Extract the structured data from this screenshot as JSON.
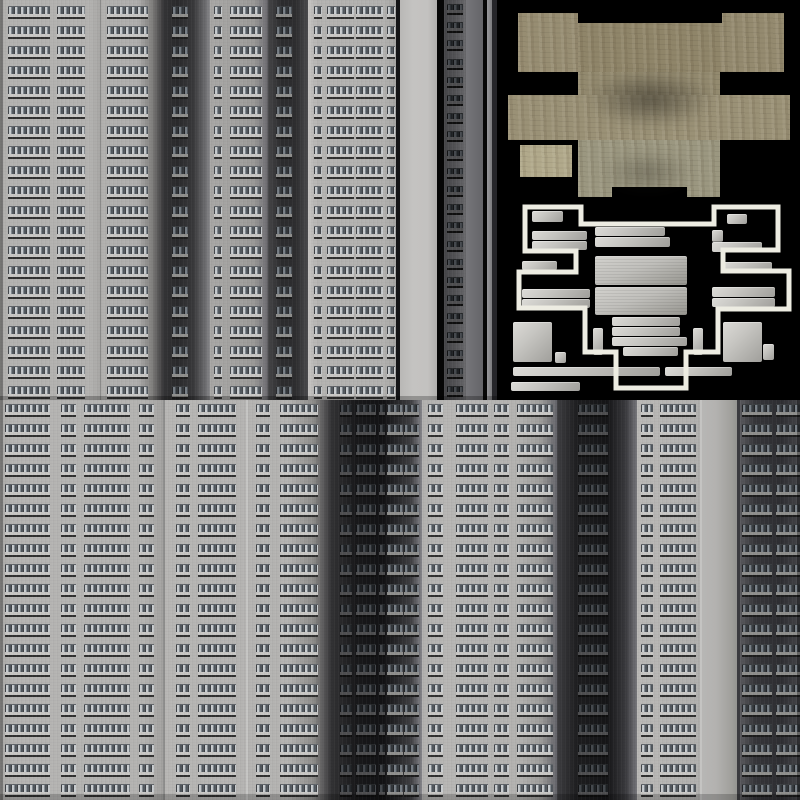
{
  "meta": {
    "description": "building facade texture atlas with rooftop diffuse map",
    "canvas": {
      "w": 800,
      "h": 800
    },
    "background_color": "#0a0a0a"
  },
  "palette": {
    "black": "#060606",
    "light_wall": "#b3b2b0",
    "roof_tan": "#978d72",
    "outline_white": "#edece2",
    "window_tones": {
      "light": {
        "top": "#61656a",
        "frame": "#3f4246",
        "pane1": "#c9cdd0",
        "pane2": "#82898f",
        "frame2": "#51575d",
        "ledge": "#c8c7c5",
        "shadow": "#303030"
      },
      "dim": {
        "top": "#3c3f42",
        "frame": "#232528",
        "pane1": "#787f86",
        "pane2": "#4b5157",
        "frame2": "#33373b",
        "ledge": "#8f8f8d",
        "shadow": "#1c1c1c"
      },
      "dark": {
        "top": "#26282a",
        "frame": "#131416",
        "pane1": "#45494e",
        "pane2": "#2b2f33",
        "frame2": "#1e2124",
        "ledge": "#4e4e50",
        "shadow": "#0e0e0e"
      }
    }
  },
  "top_section": {
    "y": 0,
    "h": 400,
    "rows": {
      "start": 6,
      "pitch": 20,
      "count": 20,
      "cell": 13
    },
    "strips": [
      {
        "name": "facade-t1",
        "x": 0,
        "w": 100,
        "wall": "linear-gradient(90deg,#a6a5a3 0%,#b3b2b0 6%,#b3b2b0 90%,#a8a7a5 100%)",
        "windows": [
          {
            "x": 8,
            "w": 42,
            "tone": "light"
          },
          {
            "x": 57,
            "w": 28,
            "tone": "light"
          }
        ]
      },
      {
        "name": "facade-t2",
        "x": 100,
        "w": 63,
        "wall": "linear-gradient(90deg,#b1b0ae 0%,#afaead 60%,#82817f 82%,#3a393b 100%)",
        "windows": [
          {
            "x": 7,
            "w": 41,
            "tone": "light"
          }
        ]
      },
      {
        "name": "facade-t3",
        "x": 163,
        "w": 47,
        "wall": "linear-gradient(90deg,#353537 0%,#2a2a2c 30%,#39393b 65%,#707073 92%,#8b8b8e 100%)",
        "windows": [
          {
            "x": 9,
            "w": 16,
            "tone": "dim"
          }
        ]
      },
      {
        "name": "facade-t4",
        "x": 210,
        "w": 58,
        "wall": "linear-gradient(90deg,#a8a7a5 0%,#a2a19f 45%,#9b9a98 75%,#77767a 95%,#5f5e62 100%)",
        "windows": [
          {
            "x": 4,
            "w": 8,
            "tone": "light"
          },
          {
            "x": 20,
            "w": 32,
            "tone": "light"
          }
        ]
      },
      {
        "name": "facade-t5",
        "x": 268,
        "w": 40,
        "wall": "linear-gradient(90deg,#454547 0%,#2c2c2e 35%,#2e2e30 70%,#4a4a4d 100%)",
        "windows": [
          {
            "x": 8,
            "w": 16,
            "tone": "dim"
          }
        ]
      },
      {
        "name": "facade-t6",
        "x": 308,
        "w": 88,
        "wall": "linear-gradient(90deg,#c2c1bf 0%,#b4b3b1 12%,#b2b1af 86%,#a6a5a3 100%)",
        "windows": [
          {
            "x": 6,
            "w": 8,
            "tone": "light"
          },
          {
            "x": 19,
            "w": 27,
            "tone": "light"
          },
          {
            "x": 48,
            "w": 27,
            "tone": "light"
          },
          {
            "x": 79,
            "w": 8,
            "tone": "light"
          }
        ]
      },
      {
        "name": "facade-t8-narrow",
        "x": 444,
        "w": 22,
        "wall": "linear-gradient(90deg,#454548 0%,#525255 50%,#68686b 100%)",
        "rows": {
          "start": 4,
          "pitch": 18.2,
          "count": 22,
          "cell": 11
        },
        "windows": [
          {
            "x": 3,
            "w": 16,
            "tone": "dark"
          }
        ]
      }
    ]
  },
  "bottom_section": {
    "y": 400,
    "h": 400,
    "rows": {
      "start": 404,
      "pitch": 20,
      "count": 20,
      "cell": 13
    },
    "strips": [
      {
        "name": "facade-b1",
        "x": 0,
        "w": 163,
        "wall": "linear-gradient(90deg,#a9a8a6 0%,#b5b4b2 8%,#b4b3b1 88%,#a3a2a0 100%)",
        "windows": [
          {
            "x": 5,
            "w": 45,
            "tone": "light"
          },
          {
            "x": 61,
            "w": 15,
            "tone": "light"
          },
          {
            "x": 84,
            "w": 46,
            "tone": "light"
          },
          {
            "x": 139,
            "w": 15,
            "tone": "light"
          }
        ]
      },
      {
        "name": "facade-b2",
        "x": 163,
        "w": 167,
        "wall": "linear-gradient(90deg,#b7b6b4 0%,#b4b3b1 75%,#8e8d8b 90%,#4a494b 98%,#3a393b 100%)",
        "windows": [
          {
            "x": 13,
            "w": 14,
            "tone": "light"
          },
          {
            "x": 35,
            "w": 38,
            "tone": "light"
          },
          {
            "x": 93,
            "w": 14,
            "tone": "light"
          },
          {
            "x": 117,
            "w": 38,
            "tone": "light"
          }
        ]
      },
      {
        "name": "facade-b3-dark",
        "x": 330,
        "w": 92,
        "wall": "linear-gradient(90deg,#343436 0%,#19191b 28%,#121214 58%,#3f3f42 88%,#85858a 100%)",
        "windows": [
          {
            "x": 10,
            "w": 12,
            "tone": "dark"
          },
          {
            "x": 26,
            "w": 20,
            "tone": "dark"
          },
          {
            "x": 49,
            "w": 6,
            "tone": "dark"
          },
          {
            "x": 57,
            "w": 16,
            "tone": "dim"
          },
          {
            "x": 74,
            "w": 15,
            "tone": "dim"
          }
        ]
      },
      {
        "name": "facade-b4",
        "x": 422,
        "w": 135,
        "wall": "linear-gradient(90deg,#b2b1af 0%,#b7b6b4 18%,#b3b2b0 72%,#9d9c9a 88%,#64646a 100%)",
        "windows": [
          {
            "x": 6,
            "w": 15,
            "tone": "light"
          },
          {
            "x": 34,
            "w": 32,
            "tone": "light"
          },
          {
            "x": 72,
            "w": 15,
            "tone": "light"
          },
          {
            "x": 95,
            "w": 36,
            "tone": "light"
          }
        ]
      },
      {
        "name": "facade-b5-dark",
        "x": 557,
        "w": 80,
        "wall": "linear-gradient(90deg,#3e3e41 0%,#1e1e20 25%,#151517 62%,#3a3a3e 86%,#76767b 100%)",
        "windows": [
          {
            "x": 21,
            "w": 30,
            "tone": "dark"
          }
        ]
      },
      {
        "name": "facade-b6",
        "x": 637,
        "w": 63,
        "wall": "linear-gradient(90deg,#bab9b7 0%,#b5b4b2 55%,#b0afad 100%)",
        "windows": [
          {
            "x": 4,
            "w": 12,
            "tone": "light"
          },
          {
            "x": 23,
            "w": 36,
            "tone": "light"
          }
        ]
      },
      {
        "name": "facade-b8-dark",
        "x": 740,
        "w": 60,
        "wall": "linear-gradient(90deg,#5a5a5e 0%,#36363a 25%,#2e2e32 68%,#46464a 100%)",
        "windows": [
          {
            "x": 2,
            "w": 30,
            "tone": "dim"
          },
          {
            "x": 36,
            "w": 24,
            "tone": "dim"
          }
        ]
      }
    ]
  },
  "bands": [
    {
      "name": "plain-wall-t7",
      "x": 400,
      "y": 0,
      "w": 37,
      "h": 400,
      "bg": "linear-gradient(90deg,#b9b8b6 0%,#c4c3c1 35%,#c3c2c0 75%,#b0afad 100%)"
    },
    {
      "name": "divider-dark",
      "x": 396,
      "y": 0,
      "w": 4,
      "h": 400,
      "bg": "#141416"
    },
    {
      "name": "gap-black-left",
      "x": 437,
      "y": 0,
      "w": 7,
      "h": 400,
      "bg": "#060606"
    },
    {
      "name": "gray-pilaster",
      "x": 466,
      "y": 0,
      "w": 17,
      "h": 400,
      "bg": "linear-gradient(90deg,#76767a 0%,#646468 100%)"
    },
    {
      "name": "gap-black-right",
      "x": 483,
      "y": 0,
      "w": 4,
      "h": 400,
      "bg": "#060606"
    },
    {
      "name": "light-edge-stripe",
      "x": 487,
      "y": 0,
      "w": 5,
      "h": 400,
      "bg": "linear-gradient(90deg,#97979a,#7c7c7f)"
    },
    {
      "name": "dark-edge-stripe",
      "x": 492,
      "y": 0,
      "w": 5,
      "h": 400,
      "bg": "#26262a"
    },
    {
      "name": "seam-t1-t2",
      "x": 100,
      "y": 0,
      "w": 1,
      "h": 400,
      "bg": "rgba(80,80,80,0.4)"
    },
    {
      "name": "seam-t6-left",
      "x": 308,
      "y": 0,
      "w": 3,
      "h": 400,
      "bg": "rgba(198,197,195,0.55)"
    },
    {
      "name": "plain-wall-b7",
      "x": 700,
      "y": 400,
      "w": 40,
      "h": 400,
      "bg": "linear-gradient(90deg,#b8b7b5 0%,#b3b2b0 40%,#a09f9b 80%,#8e8e8c 100%)"
    },
    {
      "name": "seam-b7-left",
      "x": 700,
      "y": 400,
      "w": 2,
      "h": 400,
      "bg": "rgba(210,209,207,0.5)"
    },
    {
      "name": "seam-b7-b8",
      "x": 737,
      "y": 400,
      "w": 3,
      "h": 400,
      "bg": "#3b3b3f"
    },
    {
      "name": "seam-b1-b2",
      "x": 163,
      "y": 400,
      "w": 2,
      "h": 400,
      "bg": "rgba(96,96,96,0.45)"
    },
    {
      "name": "seam-b2-mid",
      "x": 246,
      "y": 400,
      "w": 2,
      "h": 400,
      "bg": "rgba(255,255,255,0.22)"
    },
    {
      "name": "edge-shadow-left",
      "x": 0,
      "y": 0,
      "w": 3,
      "h": 800,
      "bg": "rgba(0,0,0,0.30)"
    },
    {
      "name": "edge-shadow-right",
      "x": 797,
      "y": 400,
      "w": 3,
      "h": 400,
      "bg": "rgba(0,0,0,0.30)"
    },
    {
      "name": "halves-divider-shadow",
      "x": 0,
      "y": 396,
      "w": 497,
      "h": 4,
      "bg": "rgba(0,0,0,0.25)"
    },
    {
      "name": "bottom-edge-shadow",
      "x": 0,
      "y": 794,
      "w": 800,
      "h": 6,
      "bg": "rgba(0,0,0,0.20)"
    }
  ],
  "roof": {
    "x": 497,
    "y": 0,
    "w": 303,
    "h": 400,
    "tan_slabs": [
      {
        "name": "roof-slab-tab-left",
        "x": 518,
        "y": 13,
        "w": 60,
        "h": 59,
        "color": "#978d72"
      },
      {
        "name": "roof-slab-bridge",
        "x": 578,
        "y": 23,
        "w": 144,
        "h": 49,
        "color": "#8f8569"
      },
      {
        "name": "roof-slab-tab-right",
        "x": 722,
        "y": 13,
        "w": 62,
        "h": 59,
        "color": "#948a6f"
      },
      {
        "name": "roof-slab-neck",
        "x": 578,
        "y": 72,
        "w": 142,
        "h": 23,
        "color": "#938a6f"
      },
      {
        "name": "roof-slab-arms",
        "x": 508,
        "y": 95,
        "w": 282,
        "h": 45,
        "color": "#9a9176"
      },
      {
        "name": "roof-slab-column",
        "x": 578,
        "y": 140,
        "w": 142,
        "h": 57,
        "color": "#9b9780"
      },
      {
        "name": "roof-slab-small",
        "x": 520,
        "y": 145,
        "w": 52,
        "h": 32,
        "color": "#b1a98b"
      }
    ],
    "notches": [
      {
        "name": "roof-notch",
        "x": 612,
        "y": 187,
        "w": 75,
        "h": 10
      }
    ],
    "smudges": [
      {
        "x": 585,
        "y": 70,
        "w": 130,
        "h": 58,
        "alpha": 0.55
      },
      {
        "x": 600,
        "y": 150,
        "w": 95,
        "h": 45,
        "alpha": 0.3
      }
    ],
    "outline_path": "M 525 207 H 581 V 224 H 714 V 207 H 778 V 250 H 723 V 271 H 789 V 309 H 718 V 352 H 686 V 388 H 616 V 352 H 585 V 308 H 519 V 272 H 576 V 251 H 525 Z",
    "outline_stroke_width": 5,
    "units": [
      {
        "x": 532,
        "y": 211,
        "w": 31,
        "h": 11
      },
      {
        "x": 532,
        "y": 231,
        "w": 55,
        "h": 9
      },
      {
        "x": 532,
        "y": 241,
        "w": 55,
        "h": 9
      },
      {
        "x": 595,
        "y": 227,
        "w": 70,
        "h": 9
      },
      {
        "x": 595,
        "y": 237,
        "w": 75,
        "h": 10
      },
      {
        "x": 522,
        "y": 261,
        "w": 35,
        "h": 9
      },
      {
        "x": 595,
        "y": 256,
        "w": 92,
        "h": 29,
        "big": true
      },
      {
        "x": 595,
        "y": 287,
        "w": 92,
        "h": 28,
        "big": true
      },
      {
        "x": 522,
        "y": 289,
        "w": 68,
        "h": 9
      },
      {
        "x": 522,
        "y": 299,
        "w": 68,
        "h": 9
      },
      {
        "x": 727,
        "y": 214,
        "w": 20,
        "h": 10
      },
      {
        "x": 712,
        "y": 230,
        "w": 11,
        "h": 12
      },
      {
        "x": 712,
        "y": 242,
        "w": 50,
        "h": 10
      },
      {
        "x": 722,
        "y": 262,
        "w": 50,
        "h": 9
      },
      {
        "x": 712,
        "y": 287,
        "w": 63,
        "h": 10
      },
      {
        "x": 712,
        "y": 298,
        "w": 63,
        "h": 9
      },
      {
        "x": 513,
        "y": 322,
        "w": 39,
        "h": 40
      },
      {
        "x": 555,
        "y": 352,
        "w": 11,
        "h": 11
      },
      {
        "x": 593,
        "y": 328,
        "w": 10,
        "h": 27
      },
      {
        "x": 612,
        "y": 317,
        "w": 68,
        "h": 9
      },
      {
        "x": 612,
        "y": 327,
        "w": 68,
        "h": 9
      },
      {
        "x": 612,
        "y": 337,
        "w": 75,
        "h": 9
      },
      {
        "x": 623,
        "y": 347,
        "w": 55,
        "h": 9
      },
      {
        "x": 693,
        "y": 328,
        "w": 10,
        "h": 27
      },
      {
        "x": 723,
        "y": 322,
        "w": 39,
        "h": 40
      },
      {
        "x": 763,
        "y": 344,
        "w": 11,
        "h": 16
      },
      {
        "x": 513,
        "y": 367,
        "w": 147,
        "h": 9
      },
      {
        "x": 665,
        "y": 367,
        "w": 67,
        "h": 9
      },
      {
        "x": 511,
        "y": 382,
        "w": 69,
        "h": 9
      }
    ]
  }
}
